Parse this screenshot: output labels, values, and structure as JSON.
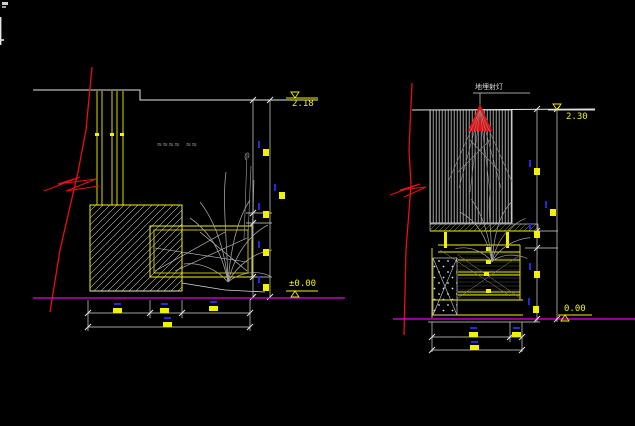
{
  "app": {
    "type": "cad-drawing-viewport",
    "background": "#000000"
  },
  "colors": {
    "outline_white": "#e6e6e6",
    "entity_yellow": "#f2f200",
    "break_red": "#e81010",
    "ground_magenta": "#e800e8",
    "foliage_gray": "#a0a0a0",
    "dim_blue": "#2828d8"
  },
  "left_view": {
    "elevation_top": "2.18",
    "elevation_bottom": "±0.00",
    "ripple_marks": "≈≈≈≈ ≈≈"
  },
  "right_view": {
    "fixture_label": "地埋射灯",
    "elevation_top": "2.30",
    "elevation_bottom": "0.00"
  }
}
